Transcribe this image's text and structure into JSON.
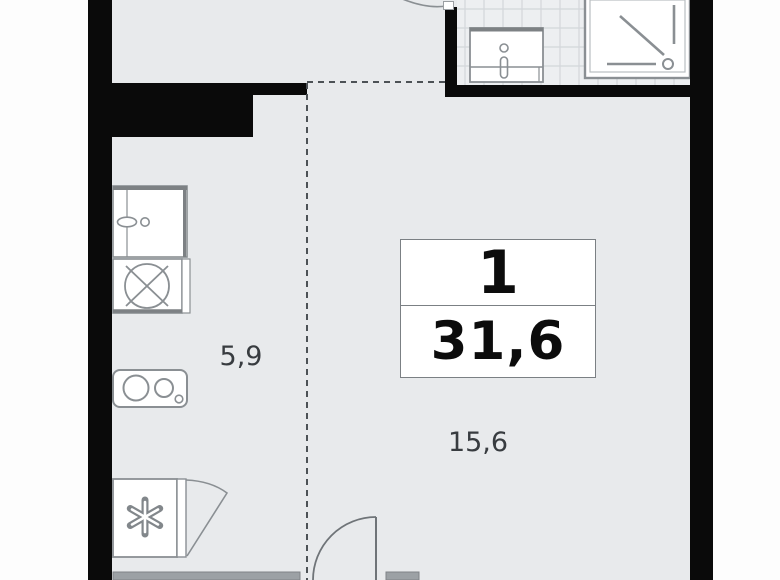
{
  "floor_plan": {
    "unit_label": {
      "rooms_count": "1",
      "total_area": "31,6"
    },
    "room_areas": {
      "kitchen": "5,9",
      "living_room": "15,6"
    },
    "fixtures": {
      "bathroom": [
        "bathroom-sink",
        "shower-cabin",
        "bathroom-door-arc"
      ],
      "kitchen": [
        "washing-machine",
        "kitchen-sink-cross",
        "stove-two-burners",
        "refrigerator",
        "closet-door"
      ],
      "room": [
        "entry-door-arc",
        "window-sill"
      ]
    },
    "colors": {
      "floor": "#e8eaec",
      "bathroom_tile": "#edeff1",
      "tile_line": "#d3d7da",
      "wall": "#0a0a0a",
      "fixture_outline": "#8a8f93",
      "dashed_line": "#4d5256",
      "sill": "#9ca1a5",
      "area_text": "#383c40",
      "bold_text": "#0c0c0c"
    }
  }
}
